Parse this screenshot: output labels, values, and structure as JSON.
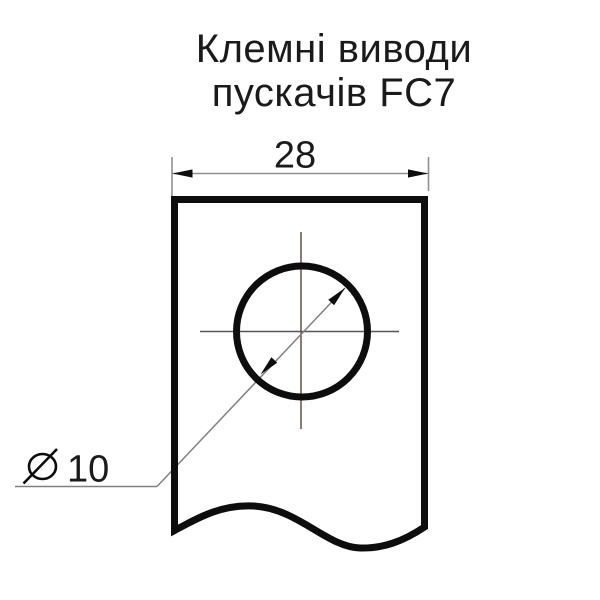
{
  "title": {
    "line1": "Клемні виводи",
    "line2": "пускачів FC7"
  },
  "drawing": {
    "type": "technical-drawing",
    "subject": "terminal-plate-with-hole",
    "plate_width_dimension": {
      "value": "28",
      "units": "mm (implied)"
    },
    "hole_diameter_dimension": {
      "symbol": "⌀",
      "value": "10",
      "label": "⌀10",
      "units": "mm (implied)"
    }
  },
  "colors": {
    "ink": "#0d0d0d",
    "dim_line": "#8f8f8f",
    "leader_line": "#808080",
    "centerline_vertical": "#5e4040",
    "centerline_horizontal": "#555555",
    "text": "#1a1a1a",
    "background": "#ffffff"
  }
}
